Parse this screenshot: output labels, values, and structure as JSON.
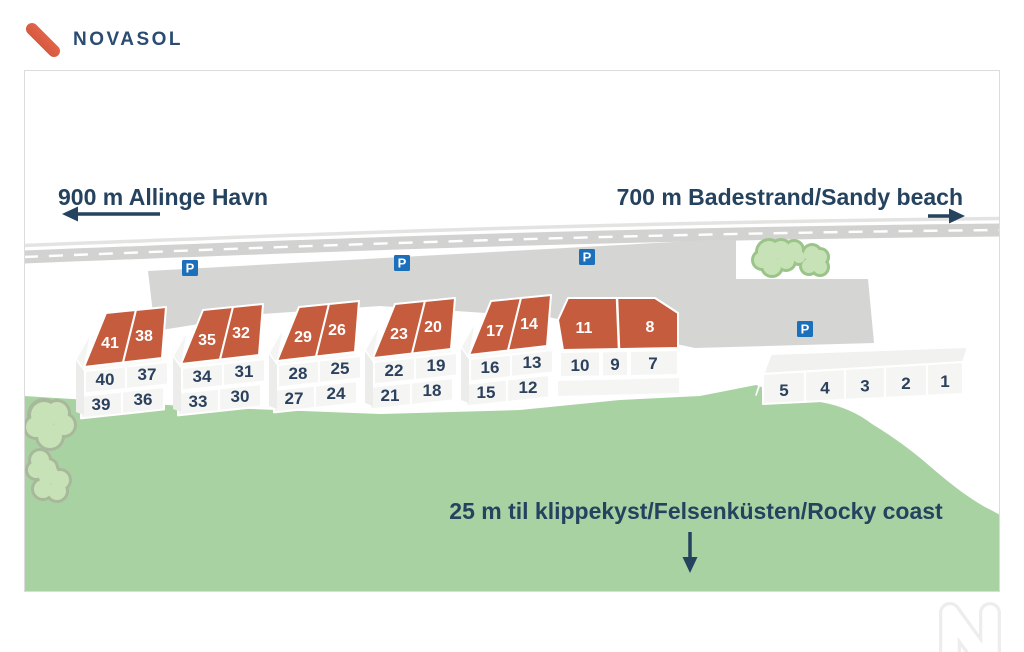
{
  "header": {
    "brand": "NOVASOL"
  },
  "map": {
    "distance_labels": {
      "harbor": "900 m Allinge Havn",
      "beach": "700 m Badestrand/Sandy beach",
      "coast": "25 m til klippekyst/Felsenküsten/Rocky coast"
    },
    "parking_sign": "P",
    "houses": [
      {
        "roofs": [
          "41",
          "38"
        ],
        "units": [
          [
            "40",
            "37"
          ],
          [
            "39",
            "36"
          ]
        ]
      },
      {
        "roofs": [
          "35",
          "32"
        ],
        "units": [
          [
            "34",
            "31"
          ],
          [
            "33",
            "30"
          ]
        ]
      },
      {
        "roofs": [
          "29",
          "26"
        ],
        "units": [
          [
            "28",
            "25"
          ],
          [
            "27",
            "24"
          ]
        ]
      },
      {
        "roofs": [
          "23",
          "20"
        ],
        "units": [
          [
            "22",
            "19"
          ],
          [
            "21",
            "18"
          ]
        ]
      },
      {
        "roofs": [
          "17",
          "14"
        ],
        "units": [
          [
            "16",
            "13"
          ],
          [
            "15",
            "12"
          ]
        ]
      },
      {
        "roofs": [
          "11",
          "8"
        ],
        "units": [
          [
            "10",
            "9",
            "7"
          ]
        ]
      },
      {
        "units": [
          [
            "5",
            "4",
            "3",
            "2",
            "1"
          ]
        ]
      }
    ],
    "colors": {
      "roof_orange": "#c55c3d",
      "parking_blue": "#1b6fbb",
      "grass_green": "#a9d2a3",
      "map_navy": "#25425f",
      "logo_orange": "#dd5f43"
    }
  }
}
